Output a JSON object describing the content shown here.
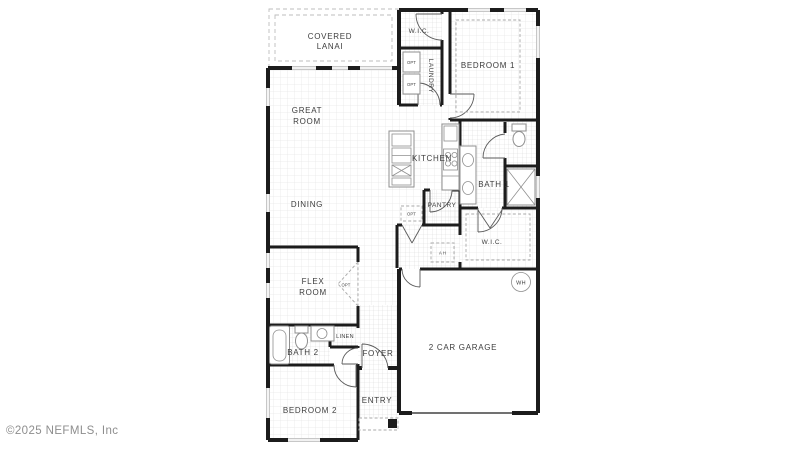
{
  "watermark": {
    "text": "©2025 NEFMLS, Inc"
  },
  "colors": {
    "walls": "#1c1c1c",
    "labels": "#3d3d3d",
    "fixtures": "#8f8f8f",
    "grid": "#e6e6e6",
    "watermark": "#8e8e8e"
  },
  "floorplan": {
    "rooms": {
      "covered_lanai_line1": "COVERED",
      "covered_lanai_line2": "LANAI",
      "wic_top": "W.I.C.",
      "laundry": "LAUNDRY",
      "bedroom1": "BEDROOM 1",
      "great_room_line1": "GREAT",
      "great_room_line2": "ROOM",
      "dining": "DINING",
      "kitchen": "KITCHEN",
      "bath1": "BATH 1",
      "pantry": "PANTRY",
      "wic_main": "W.I.C.",
      "flex_line1": "FLEX",
      "flex_line2": "ROOM",
      "bath2": "BATH 2",
      "linen": "LINEN",
      "foyer": "FOYER",
      "entry": "ENTRY",
      "bedroom2": "BEDROOM 2",
      "garage": "2 CAR GARAGE"
    },
    "annotations": {
      "opt": "OPT",
      "water_heater": "WH",
      "air_handler": "A H"
    }
  }
}
